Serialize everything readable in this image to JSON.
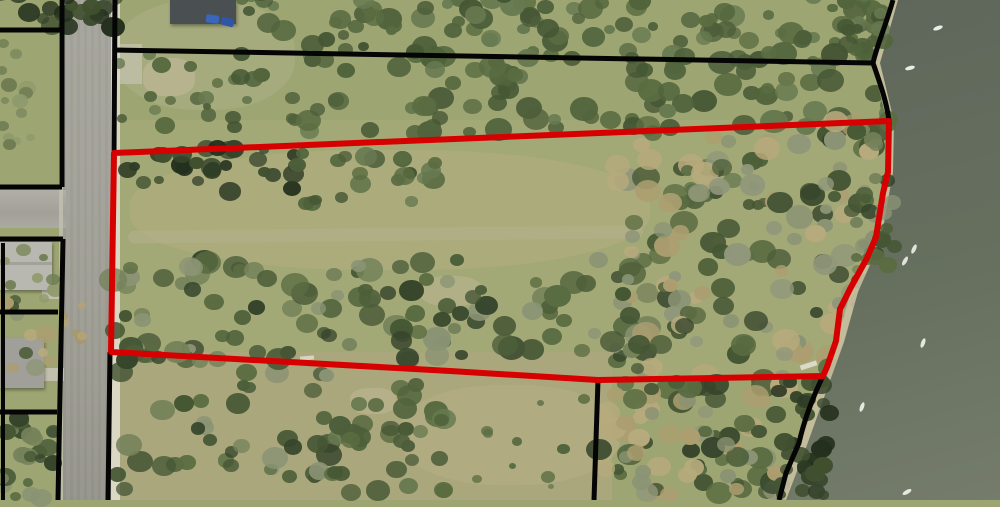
{
  "map": {
    "title": "aerial-parcel-map",
    "description": "Aerial photograph with parcel lines; one waterfront parcel outlined in red between a street on the west and a water body on the east",
    "colors": {
      "boundary_red": "#d60000",
      "parcel_black": "#050505",
      "water_dark": "#5f675b",
      "water_light": "#757c6c",
      "grass": "#9da573",
      "field": "#aca87e",
      "road": "#a2a199",
      "sidewalk": "#dedbcb",
      "beach": "#c6bfa0",
      "roof_dark": "#4a4f52",
      "roof_light": "#b9b8b0",
      "car_blue": "#3a66bd"
    },
    "features": {
      "highlighted_parcel": "red-outlined waterfront parcel",
      "water_body": "water along east edge",
      "street_west": "north-south street",
      "cross_street": "east-west side street",
      "boats_count": 7,
      "houses_count": 3
    }
  }
}
